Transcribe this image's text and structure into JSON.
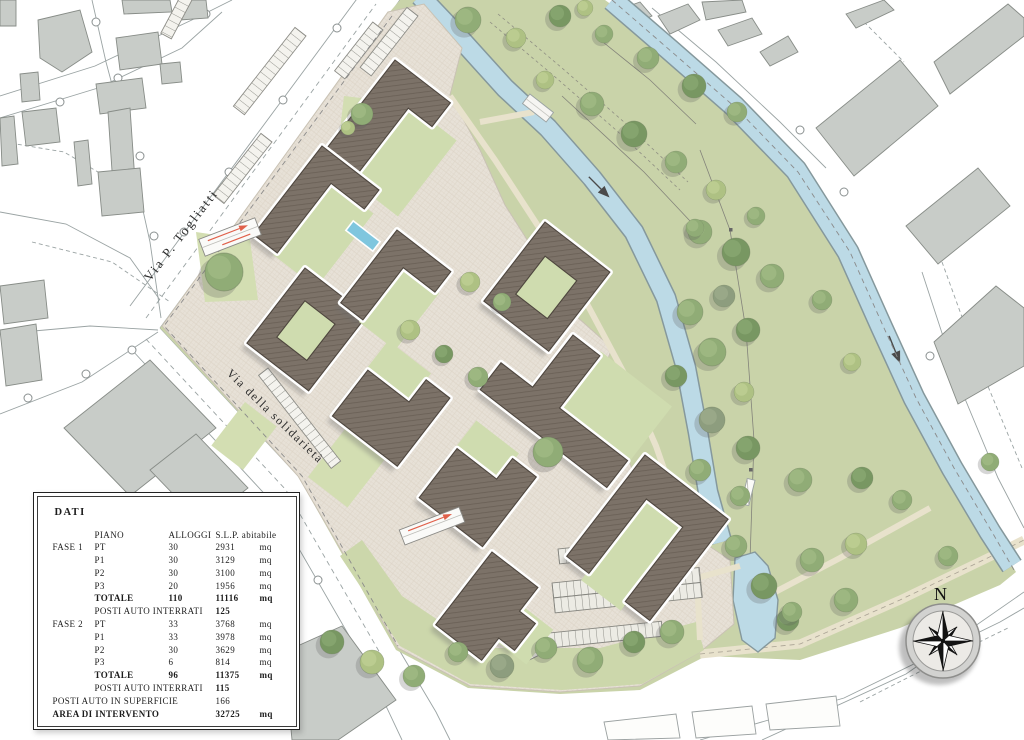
{
  "map": {
    "street_labels": [
      {
        "id": "togliatti",
        "text": "Via P. Togliatti"
      },
      {
        "id": "solidarieta",
        "text": "Via della solidarietà"
      }
    ],
    "compass_label": "N",
    "palette": {
      "paving": "#e7e1d7",
      "lawn": "#d3deb2",
      "park_green": "#c9d3a9",
      "water": "#bcdae6",
      "roof": "#7c7268",
      "context_building": "#c8ccc8",
      "ramp_arrow": "#e0604a"
    }
  },
  "dati_panel": {
    "title": "DATI",
    "header": {
      "piano": "PIANO",
      "alloggi": "ALLOGGI",
      "slp": "S.L.P. abitabile"
    },
    "rows": [
      {
        "fase": "FASE 1",
        "piano": "PT",
        "alloggi": "30",
        "slp": "2931",
        "unit": "mq"
      },
      {
        "piano": "P1",
        "alloggi": "30",
        "slp": "3129",
        "unit": "mq"
      },
      {
        "piano": "P2",
        "alloggi": "30",
        "slp": "3100",
        "unit": "mq"
      },
      {
        "piano": "P3",
        "alloggi": "20",
        "slp": "1956",
        "unit": "mq"
      },
      {
        "piano": "TOTALE",
        "alloggi": "110",
        "slp": "11116",
        "unit": "mq",
        "style": "bold"
      },
      {
        "piano": "POSTI AUTO INTERRATI",
        "slp": "125",
        "span": "span-p2",
        "style": "vbold"
      },
      {
        "fase": "FASE 2",
        "piano": "PT",
        "alloggi": "33",
        "slp": "3768",
        "unit": "mq"
      },
      {
        "piano": "P1",
        "alloggi": "33",
        "slp": "3978",
        "unit": "mq"
      },
      {
        "piano": "P2",
        "alloggi": "30",
        "slp": "3629",
        "unit": "mq"
      },
      {
        "piano": "P3",
        "alloggi": "6",
        "slp": "814",
        "unit": "mq"
      },
      {
        "piano": "TOTALE",
        "alloggi": "96",
        "slp": "11375",
        "unit": "mq",
        "style": "bold"
      },
      {
        "piano": "POSTI AUTO INTERRATI",
        "slp": "115",
        "span": "span-p2",
        "style": "vbold"
      },
      {
        "fase": "POSTI AUTO IN SUPERFICIE",
        "slp": "166",
        "span": "span-l3"
      },
      {
        "fase": "AREA DI INTERVENTO",
        "slp": "32725",
        "unit": "mq",
        "span": "span-l3",
        "style": "bold"
      }
    ]
  }
}
